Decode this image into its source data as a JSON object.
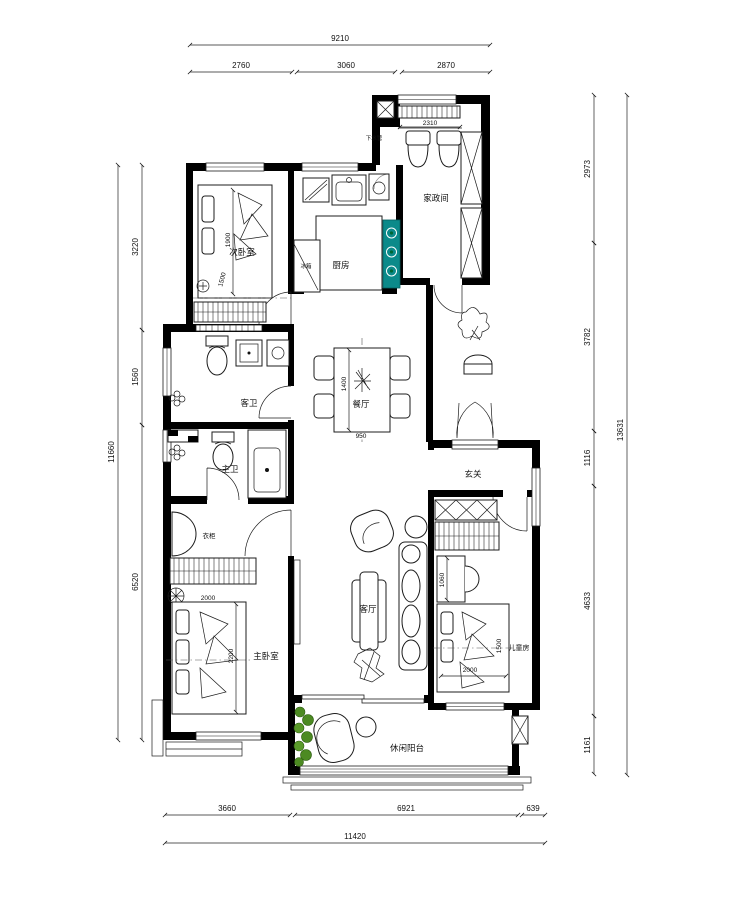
{
  "plan": {
    "type": "apartment-floor-plan"
  },
  "dims": {
    "top_total": "9210",
    "top": [
      "2760",
      "3060",
      "2870"
    ],
    "left_total": "11660",
    "left": [
      "3220",
      "1560",
      "6520"
    ],
    "right_total": "13631",
    "right": [
      "2973",
      "3782",
      "1116",
      "4633",
      "1161"
    ],
    "bottom_total": "11420",
    "bottom": [
      "3660",
      "6921",
      "639"
    ]
  },
  "rooms": {
    "bedroom2": "次卧室",
    "kitchen": "厨房",
    "utility": "家政间",
    "dining": "餐厅",
    "entry": "玄关",
    "bath_guest": "客卫",
    "bath_master": "主卫",
    "master": "主卧室",
    "living": "客厅",
    "kids": "儿童房",
    "balcony": "休闲阳台"
  },
  "furniture": {
    "fridge": "冰箱",
    "wardrobe": "衣柜",
    "drain": "下水管"
  },
  "sizes": {
    "bed2_len": "1900",
    "bed2_wid": "1500",
    "counter": "2310",
    "table_len": "1400",
    "table_wid": "950",
    "mbed_len": "2200",
    "mbed_wid": "2000",
    "desk": "1060",
    "kbed_len": "2000",
    "kbed_wid": "1500"
  },
  "colors": {
    "wall": "#000000",
    "stove": "#0b8a8a",
    "plant": "#4c8a22",
    "line": "#1c1c1c"
  }
}
